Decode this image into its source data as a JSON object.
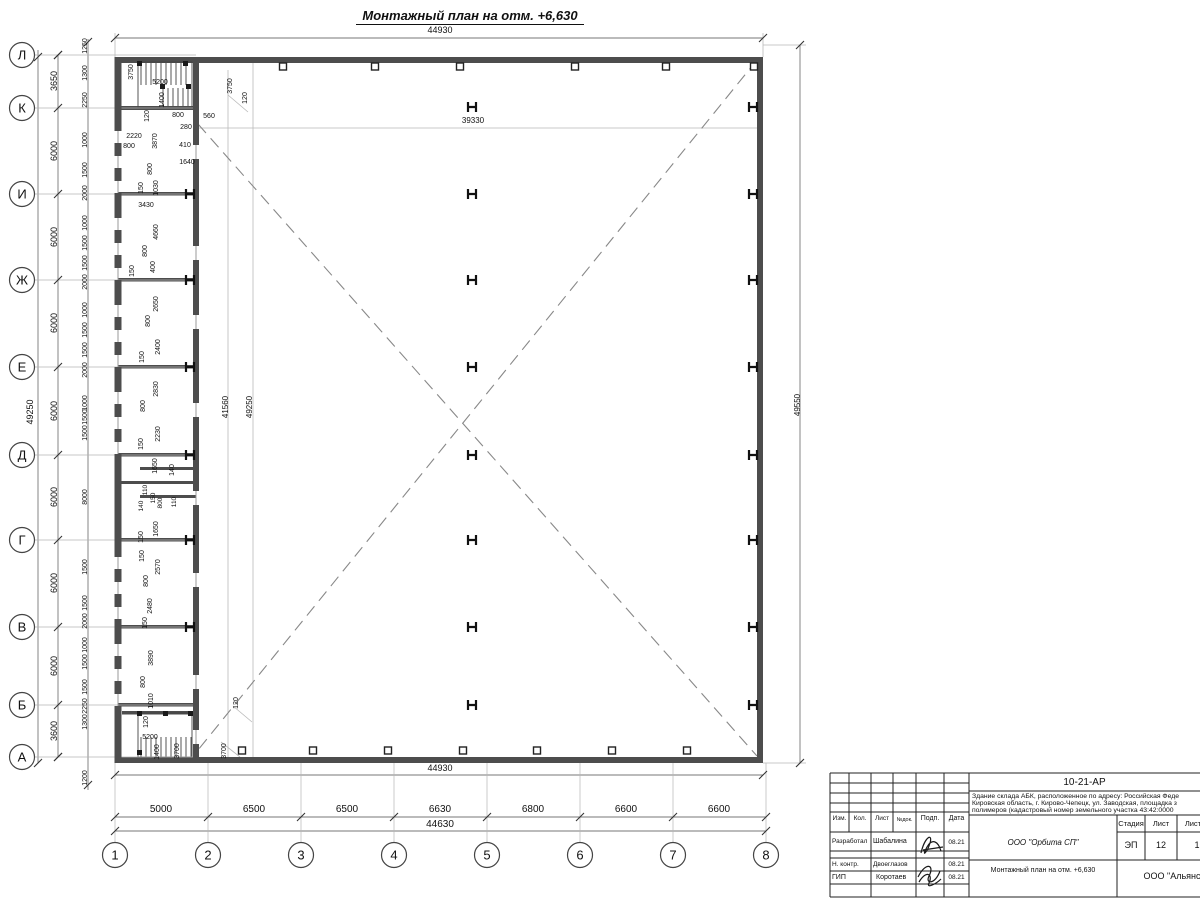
{
  "title": "Монтажный план на отм. +6,630",
  "axes": {
    "rows": [
      {
        "label": "Л",
        "y": 55
      },
      {
        "label": "К",
        "y": 108
      },
      {
        "label": "И",
        "y": 194
      },
      {
        "label": "Ж",
        "y": 280
      },
      {
        "label": "Е",
        "y": 367
      },
      {
        "label": "Д",
        "y": 455
      },
      {
        "label": "Г",
        "y": 540
      },
      {
        "label": "В",
        "y": 627
      },
      {
        "label": "Б",
        "y": 705
      },
      {
        "label": "А",
        "y": 757
      }
    ],
    "cols": [
      {
        "label": "1",
        "x": 115
      },
      {
        "label": "2",
        "x": 208
      },
      {
        "label": "3",
        "x": 301
      },
      {
        "label": "4",
        "x": 394
      },
      {
        "label": "5",
        "x": 487
      },
      {
        "label": "6",
        "x": 580
      },
      {
        "label": "7",
        "x": 673
      },
      {
        "label": "8",
        "x": 766
      }
    ]
  },
  "drawing": {
    "h_columns": {
      "left": {
        "x": 190,
        "ys": [
          194,
          280,
          367,
          455,
          540,
          627
        ]
      },
      "mid": {
        "x": 472,
        "ys": [
          107,
          194,
          280,
          367,
          455,
          540,
          627,
          705
        ]
      },
      "right": {
        "x": 753,
        "ys": [
          107,
          194,
          280,
          367,
          455,
          540,
          627,
          705
        ]
      }
    },
    "squares_top": [
      283,
      375,
      460,
      575,
      666,
      754
    ],
    "squares_bottom": [
      242,
      313,
      388,
      463,
      537,
      612,
      687
    ],
    "window_gaps": [
      137,
      162,
      187,
      224,
      249,
      274,
      311,
      336,
      361,
      398,
      423,
      448,
      563,
      588,
      613,
      650,
      675,
      700
    ],
    "door_gaps": [
      152,
      253,
      322,
      410,
      498,
      580,
      682,
      737
    ],
    "extra_ticks": [
      [
        115,
        38
      ],
      [
        763,
        38
      ],
      [
        38,
        57
      ],
      [
        38,
        763
      ],
      [
        115,
        775
      ],
      [
        763,
        775
      ],
      [
        115,
        831
      ],
      [
        766,
        831
      ],
      [
        800,
        45
      ],
      [
        800,
        763
      ],
      [
        88,
        42
      ],
      [
        88,
        785
      ],
      [
        58,
        55
      ],
      [
        58,
        757
      ]
    ],
    "labels": [
      [
        440,
        33,
        "44930",
        0,
        9
      ],
      [
        473,
        123,
        "39330",
        0,
        8
      ],
      [
        228,
        407,
        "41560",
        1,
        8
      ],
      [
        252,
        407,
        "49250",
        1,
        8
      ],
      [
        800,
        405,
        "49550",
        1,
        8
      ],
      [
        33,
        412,
        "49250",
        1,
        9
      ],
      [
        440,
        771,
        "44930",
        0,
        9
      ],
      [
        440,
        827,
        "44630",
        0,
        10
      ],
      [
        161,
        812,
        "5000",
        0,
        10
      ],
      [
        254,
        812,
        "6500",
        0,
        10
      ],
      [
        347,
        812,
        "6500",
        0,
        10
      ],
      [
        440,
        812,
        "6630",
        0,
        10
      ],
      [
        533,
        812,
        "6800",
        0,
        10
      ],
      [
        626,
        812,
        "6600",
        0,
        10
      ],
      [
        719,
        812,
        "6600",
        0,
        10
      ],
      [
        57,
        81,
        "3650",
        1,
        9
      ],
      [
        57,
        151,
        "6000",
        1,
        9
      ],
      [
        57,
        237,
        "6000",
        1,
        9
      ],
      [
        57,
        323,
        "6000",
        1,
        9
      ],
      [
        57,
        411,
        "6000",
        1,
        9
      ],
      [
        57,
        497,
        "6000",
        1,
        9
      ],
      [
        57,
        583,
        "6000",
        1,
        9
      ],
      [
        57,
        666,
        "6000",
        1,
        9
      ],
      [
        57,
        731,
        "3600",
        1,
        9
      ],
      [
        87,
        46,
        "1250",
        1,
        7
      ],
      [
        87,
        73,
        "1300",
        1,
        7
      ],
      [
        87,
        100,
        "2250",
        1,
        7
      ],
      [
        87,
        140,
        "1000",
        1,
        7
      ],
      [
        87,
        170,
        "1500",
        1,
        7
      ],
      [
        87,
        193,
        "2000",
        1,
        7
      ],
      [
        87,
        223,
        "1000",
        1,
        7
      ],
      [
        87,
        243,
        "1500",
        1,
        7
      ],
      [
        87,
        263,
        "1500",
        1,
        7
      ],
      [
        87,
        282,
        "2000",
        1,
        7
      ],
      [
        87,
        310,
        "1000",
        1,
        7
      ],
      [
        87,
        330,
        "1500",
        1,
        7
      ],
      [
        87,
        350,
        "1500",
        1,
        7
      ],
      [
        87,
        370,
        "2000",
        1,
        7
      ],
      [
        87,
        403,
        "1000",
        1,
        7
      ],
      [
        87,
        417,
        "1500",
        1,
        7
      ],
      [
        87,
        433,
        "1500",
        1,
        7
      ],
      [
        87,
        497,
        "8000",
        1,
        7
      ],
      [
        87,
        567,
        "1500",
        1,
        7
      ],
      [
        87,
        603,
        "1500",
        1,
        7
      ],
      [
        87,
        621,
        "2000",
        1,
        7
      ],
      [
        87,
        645,
        "1000",
        1,
        7
      ],
      [
        87,
        662,
        "1500",
        1,
        7
      ],
      [
        87,
        687,
        "1500",
        1,
        7
      ],
      [
        87,
        706,
        "2250",
        1,
        7
      ],
      [
        87,
        722,
        "1300",
        1,
        7
      ],
      [
        87,
        778,
        "1200",
        1,
        7
      ],
      [
        133,
        72,
        "3750",
        1,
        7
      ],
      [
        160,
        84,
        "5200",
        0,
        7
      ],
      [
        164,
        100,
        "1400",
        1,
        7
      ],
      [
        149,
        116,
        "120",
        1,
        7
      ],
      [
        178,
        117,
        "800",
        0,
        7
      ],
      [
        209,
        118,
        "560",
        0,
        7
      ],
      [
        186,
        129,
        "280",
        0,
        7
      ],
      [
        134,
        138,
        "2220",
        0,
        7
      ],
      [
        129,
        148,
        "800",
        0,
        7
      ],
      [
        157,
        141,
        "3870",
        1,
        7
      ],
      [
        185,
        147,
        "410",
        0,
        7
      ],
      [
        187,
        164,
        "1640",
        0,
        7
      ],
      [
        152,
        169,
        "800",
        1,
        7
      ],
      [
        143,
        188,
        "150",
        1,
        7
      ],
      [
        158,
        188,
        "1030",
        1,
        7
      ],
      [
        146,
        207,
        "3430",
        0,
        7
      ],
      [
        232,
        86,
        "3750",
        1,
        7
      ],
      [
        247,
        98,
        "120",
        1,
        7
      ],
      [
        158,
        232,
        "4660",
        1,
        7
      ],
      [
        147,
        251,
        "800",
        1,
        7
      ],
      [
        155,
        267,
        "400",
        1,
        7
      ],
      [
        134,
        271,
        "150",
        1,
        7
      ],
      [
        158,
        304,
        "2650",
        1,
        7
      ],
      [
        150,
        321,
        "800",
        1,
        7
      ],
      [
        160,
        347,
        "2400",
        1,
        7
      ],
      [
        144,
        357,
        "150",
        1,
        7
      ],
      [
        158,
        389,
        "2830",
        1,
        7
      ],
      [
        145,
        406,
        "800",
        1,
        7
      ],
      [
        160,
        434,
        "2230",
        1,
        7
      ],
      [
        143,
        444,
        "150",
        1,
        7
      ],
      [
        157,
        466,
        "1650",
        1,
        7
      ],
      [
        174,
        470,
        "140",
        1,
        7
      ],
      [
        147,
        490,
        "110",
        1,
        6.5
      ],
      [
        155,
        498,
        "150",
        1,
        6.5
      ],
      [
        143,
        506,
        "140",
        1,
        6.5
      ],
      [
        162,
        503,
        "800",
        1,
        6.5
      ],
      [
        176,
        502,
        "110",
        1,
        6.5
      ],
      [
        158,
        529,
        "1650",
        1,
        7
      ],
      [
        143,
        537,
        "150",
        1,
        7
      ],
      [
        144,
        556,
        "150",
        1,
        7
      ],
      [
        160,
        567,
        "2570",
        1,
        7
      ],
      [
        148,
        581,
        "800",
        1,
        7
      ],
      [
        152,
        606,
        "2480",
        1,
        7
      ],
      [
        147,
        623,
        "150",
        1,
        7
      ],
      [
        153,
        658,
        "3890",
        1,
        7
      ],
      [
        145,
        682,
        "800",
        1,
        7
      ],
      [
        153,
        701,
        "1010",
        1,
        7
      ],
      [
        148,
        722,
        "120",
        1,
        7
      ],
      [
        150,
        739,
        "5200",
        0,
        7
      ],
      [
        159,
        752,
        "1400",
        1,
        7
      ],
      [
        179,
        751,
        "3700",
        1,
        7
      ],
      [
        238,
        703,
        "120",
        1,
        7
      ],
      [
        226,
        751,
        "3700",
        1,
        7
      ]
    ]
  },
  "titleblock": {
    "doc_code": "10-21-АР",
    "desc1": "Здание склада АБК, расположенное по адресу: Российская Феде",
    "desc2": "Кировская область, г. Кирово-Чепецк, ул. Заводская, площадка з",
    "desc3": "полимеров (кадастровый номер земельного участка 43:42:0000",
    "col_izm": "Изм.",
    "col_kol": "Кол.",
    "col_list": "Лист",
    "col_ndoc": "№док.",
    "col_podp": "Подп.",
    "col_data": "Дата",
    "row1_role": "Разработал",
    "row1_name": "Шабалина",
    "row1_date": "08.21",
    "row2_role": "Н. контр.",
    "row2_name": "Двоеглазов",
    "row2_date": "08.21",
    "row3_role": "ГИП",
    "row3_name": "Коротаев",
    "row3_date": "08.21",
    "org": "ООО \"Орбита СП\"",
    "stage_h": "Стадия",
    "sheet_h": "Лист",
    "sheets_h": "Листов",
    "stage_v": "ЭП",
    "sheet_v": "12",
    "sheets_v": "1",
    "sheet_title": "Монтажный план на отм. +6,630",
    "firm": "ООО \"Альянс"
  }
}
